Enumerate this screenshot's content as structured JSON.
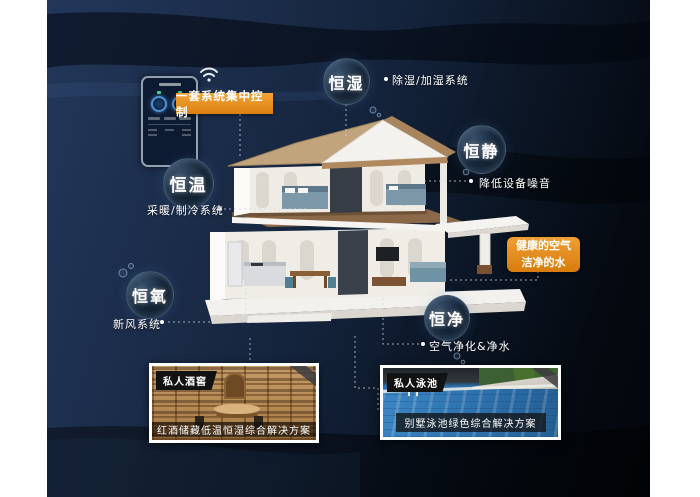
{
  "phone": {
    "tag": "一套系统集中控制"
  },
  "bubbles": [
    {
      "name": "恒湿",
      "note": "除湿/加湿系统"
    },
    {
      "name": "恒静",
      "note": "降低设备噪音"
    },
    {
      "name": "恒温",
      "note": "采暖/制冷系统"
    },
    {
      "name": "恒氧",
      "note": "新风系统"
    },
    {
      "name": "恒净",
      "note": "空气净化&净水"
    }
  ],
  "highlight": {
    "line1": "健康的空气",
    "line2": "洁净的水"
  },
  "cards": [
    {
      "tag": "私人酒窖",
      "caption": "红酒储藏低温恒湿综合解决方案"
    },
    {
      "tag": "私人泳池",
      "caption": "别墅泳池绿色综合解决方案"
    }
  ],
  "colors": {
    "accent_orange": "#e08a1e",
    "background_navy": "#16253d",
    "text": "#ffffff"
  }
}
